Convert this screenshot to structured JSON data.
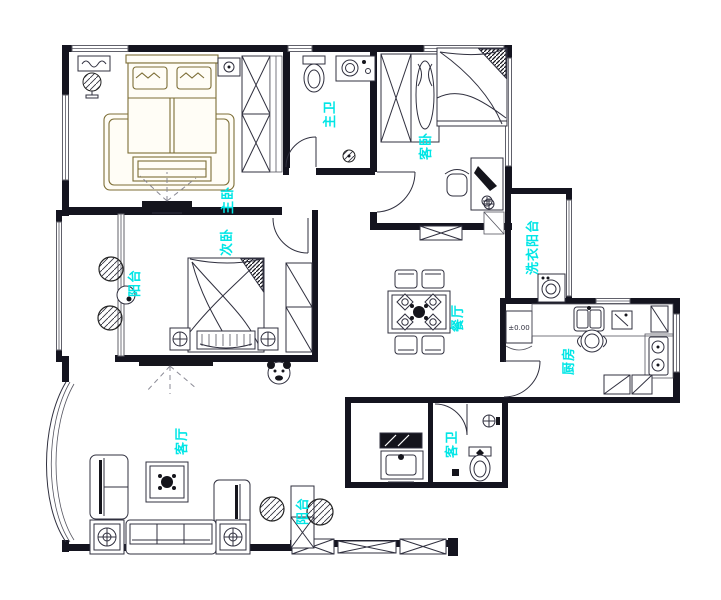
{
  "drawing": {
    "type": "apartment-floor-plan",
    "style": "CAD line drawing"
  },
  "colors": {
    "label_cyan": "#00e6e6",
    "bed_accent_olive": "#7c6d35",
    "line_dark": "#30303f",
    "wall_black": "#14141f",
    "background": "#ffffff"
  },
  "rooms": [
    {
      "id": "master-bedroom",
      "label": "主卧"
    },
    {
      "id": "master-bathroom",
      "label": "主卫"
    },
    {
      "id": "guest-bedroom",
      "label": "客卧"
    },
    {
      "id": "second-bedroom",
      "label": "次卧"
    },
    {
      "id": "side-balcony",
      "label": "阳台"
    },
    {
      "id": "laundry-balcony",
      "label": "洗衣阳台"
    },
    {
      "id": "dining-room",
      "label": "餐厅"
    },
    {
      "id": "kitchen",
      "label": "厨房"
    },
    {
      "id": "living-room",
      "label": "客厅"
    },
    {
      "id": "guest-bathroom",
      "label": "客卫"
    },
    {
      "id": "bottom-balcony",
      "label": "阳台"
    }
  ],
  "annotations": {
    "floor_level": "±0.00"
  }
}
